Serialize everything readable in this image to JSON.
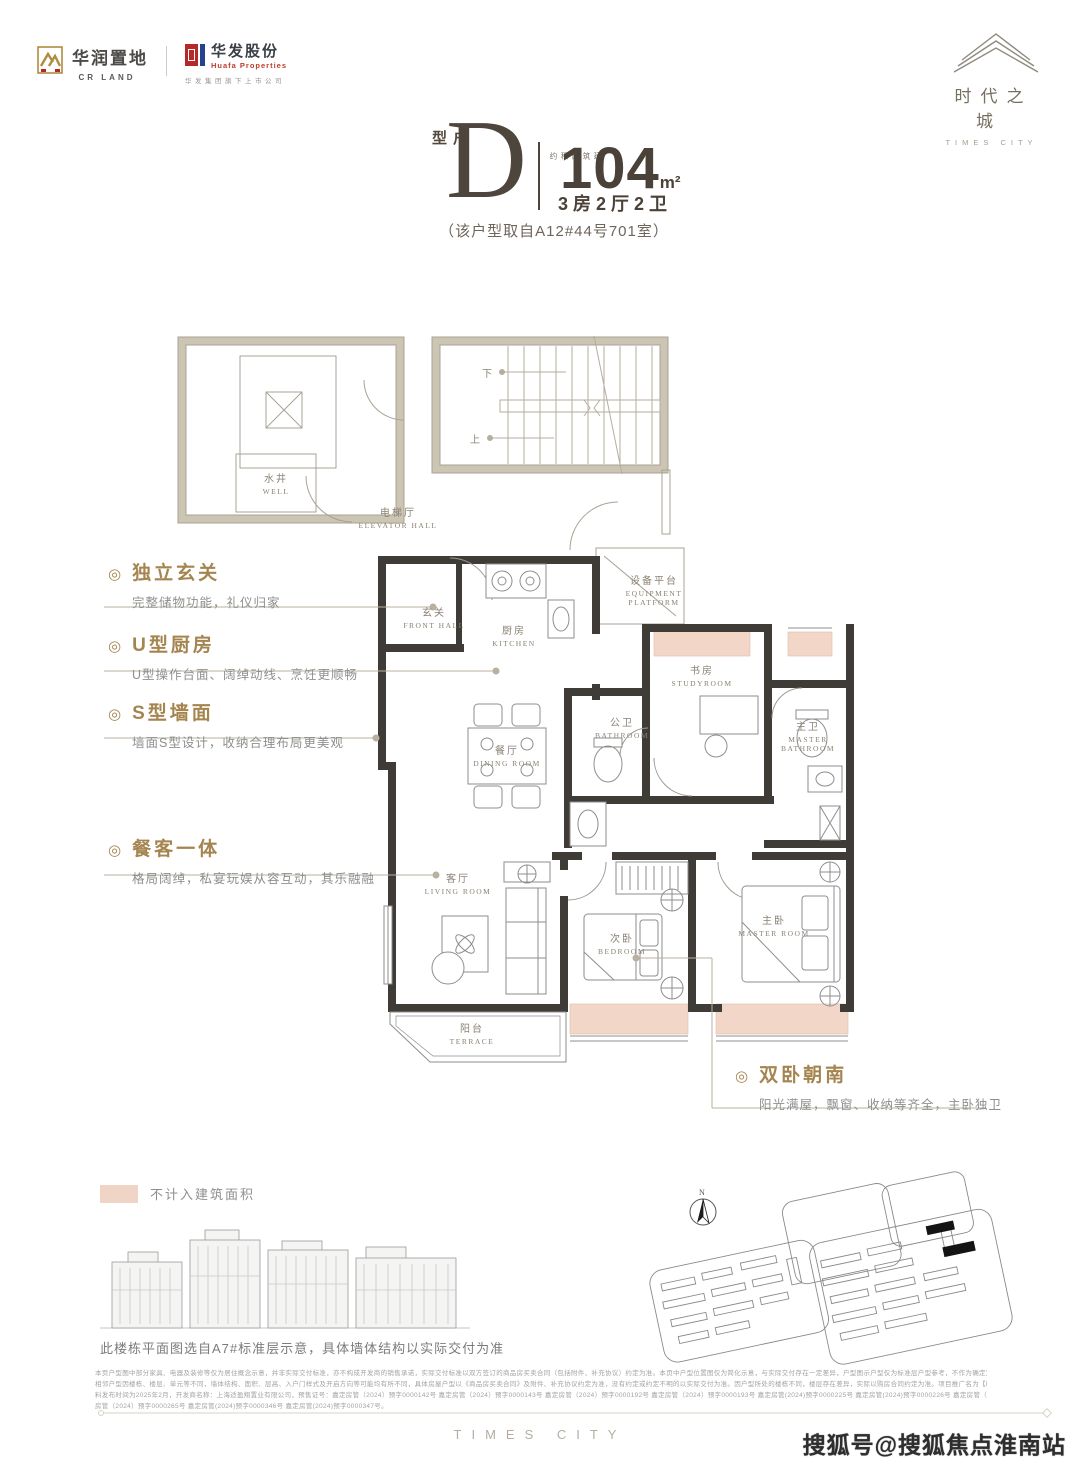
{
  "header": {
    "cr_land": {
      "name_cn": "华润置地",
      "name_en": "CR LAND"
    },
    "huafa": {
      "name_cn": "华发股份",
      "name_en": "Huafa Properties",
      "subtitle": "华发集团旗下上市公司"
    },
    "project": {
      "name_cn": "时代之城",
      "name_en": "TIMES CITY"
    }
  },
  "title": {
    "type_label": "户型",
    "type_letter": "D",
    "area_prefix": "建筑面积约",
    "area_value": "104",
    "area_unit": "m²",
    "layout": "3房2厅2卫",
    "source_note": "（该户型取自A12#44号701室）"
  },
  "misc": {
    "bullet": "◎"
  },
  "features": [
    {
      "title": "独立玄关",
      "desc": "完整储物功能，礼仪归家"
    },
    {
      "title": "U型厨房",
      "desc": "U型操作台面、阔绰动线、烹饪更顺畅"
    },
    {
      "title": "S型墙面",
      "desc": "墙面S型设计，收纳合理布局更美观"
    },
    {
      "title": "餐客一体",
      "desc": "格局阔绰，私宴玩娱从容互动，其乐融融"
    },
    {
      "title": "双卧朝南",
      "desc": "阳光满屋，飘窗、收纳等齐全，主卧独卫"
    }
  ],
  "rooms": [
    {
      "cn": "水井",
      "en": "WELL"
    },
    {
      "cn": "电梯厅",
      "en": "ELEVATOR HALL"
    },
    {
      "cn": "玄关",
      "en": "FRONT HALL"
    },
    {
      "cn": "厨房",
      "en": "KITCHEN"
    },
    {
      "cn": "设备平台",
      "en": "EQUIPMENT PLATFORM"
    },
    {
      "cn": "餐厅",
      "en": "DINING ROOM"
    },
    {
      "cn": "公卫",
      "en": "BATHROOM"
    },
    {
      "cn": "书房",
      "en": "STUDYROOM"
    },
    {
      "cn": "主卫",
      "en": "MASTER BATHROOM"
    },
    {
      "cn": "客厅",
      "en": "LIVING ROOM"
    },
    {
      "cn": "次卧",
      "en": "BEDROOM"
    },
    {
      "cn": "主卧",
      "en": "MASTER ROOM"
    },
    {
      "cn": "阳台",
      "en": "TERRACE"
    }
  ],
  "plan_markers": {
    "stair_down": "下",
    "stair_up": "上",
    "north": "N"
  },
  "legend": {
    "swatch_color": "#f0d4c5",
    "label": "不计入建筑面积"
  },
  "floor_note": "此楼栋平面图选自A7#标准层示意，具体墙体结构以实际交付为准",
  "disclaimer": {
    "lines": [
      "本页户型图中部分家具、电器及装修等仅为居住概念示意，并非实际交付标准，亦不构成开发商的销售承诺，实际交付标准以双方签订的商品房买卖合同（包括附件、补充协议）约定为准。本页中户型位置图仅为简化示意，与实际交付存在一定差异，户型图示户型仅为标准层户型参考，不作为确定双方权利义务的依据。",
      "相邻户型因楼栋、楼层、单元等不同，墙体结构、面积、层高、入户门样式及开启方向等可能均有所不同，具体房屋户型以《商品房买卖合同》及附件、补充协议约定为准，没有约定或约定不明的以实际交付为准。因户型所处的楼栋不同，楼层存在差异，实际以购房合同约定为准。项目推广名为【时代之城】，本资",
      "料发布时间为2025年2月，开发商名称：上海适盈翔置业有限公司，预售证号：嘉定房管（2024）预字0000142号 嘉定房管（2024）预字0000143号 嘉定房管（2024）预字0000192号 嘉定房管（2024）预字0000193号 嘉定房管(2024)预字0000225号 嘉定房管(2024)预字0000226号 嘉定房管（2024）预字0000264号 嘉定",
      "房管（2024）预字0000265号 嘉定房管(2024)预字0000346号 嘉定房管(2024)预字0000347号。"
    ]
  },
  "footer": {
    "brand": "TIMES CITY",
    "watermark": "搜狐号@搜狐焦点淮南站"
  },
  "colors": {
    "accent_gold": "#a5854f",
    "bay_window_pink": "#f2d7c9",
    "wall_dark": "#3f3c38",
    "huafa_red": "#b5292b",
    "huafa_blue": "#27418c",
    "crland_gold": "#b08c3e"
  }
}
